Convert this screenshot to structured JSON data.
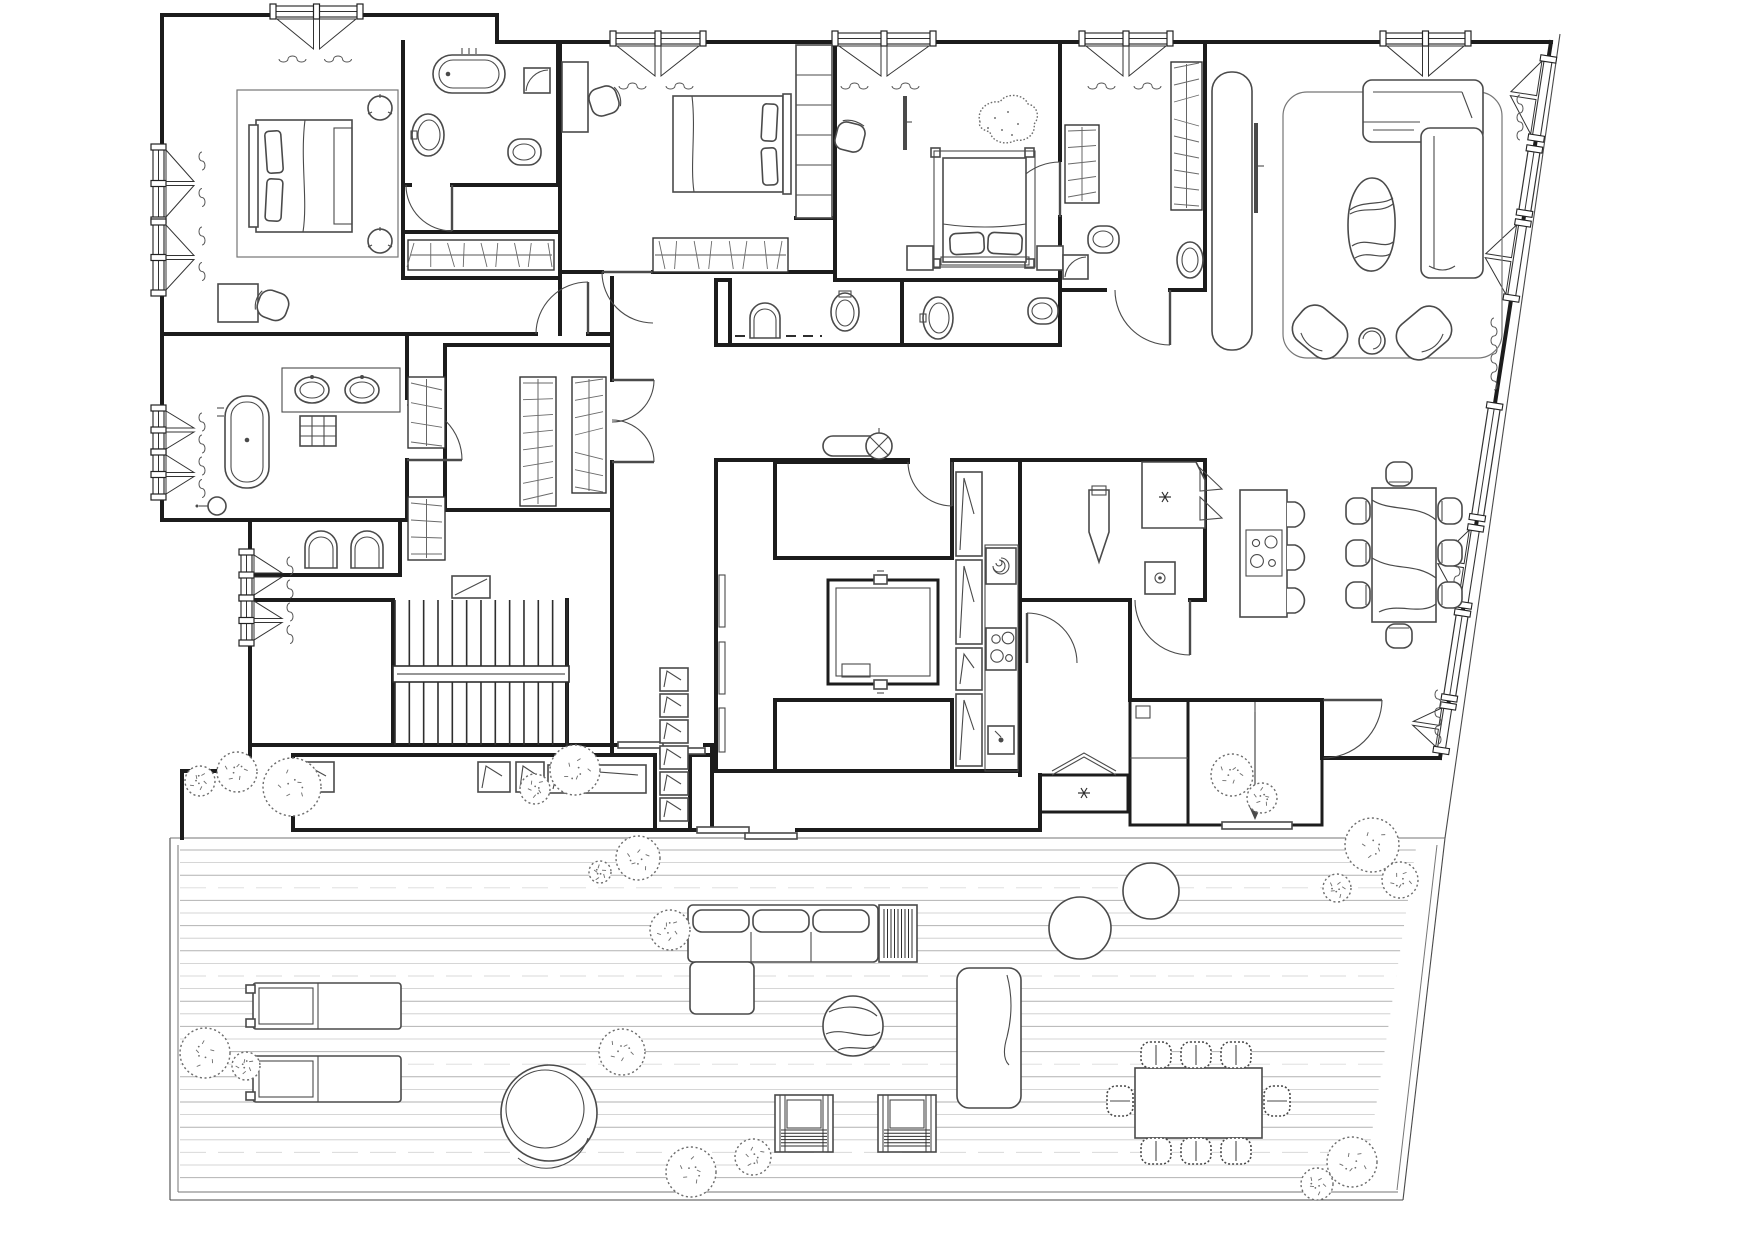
{
  "title": "Penthouse apartment floor plan with wrap-around deck terrace",
  "canvas": {
    "w": 1756,
    "h": 1242
  },
  "palette": {
    "paper": "#ffffff",
    "wall": "#1c1c1c",
    "ink": "#2e2e2e",
    "line": "#4a4a4a",
    "soft": "#767676",
    "deck": "#b2b2b2",
    "deck_alt": "#c9c9c9",
    "deck_faint": "#d9d9d9"
  },
  "deck": {
    "x1": 180,
    "y1": 850,
    "y2": 1188,
    "step": 12.6,
    "sx": 1557.5,
    "k": 0.155,
    "edge_left": [
      170,
      178
    ],
    "edge_bottom": [
      1192,
      1200
    ],
    "top": 838
  },
  "stairs": {
    "x1": 395,
    "x2": 567,
    "y_top1": 600,
    "y_top2": 666,
    "y_bot1": 682,
    "y_bot2": 745,
    "step": 14.33,
    "rail": [
      393,
      666,
      176,
      16
    ]
  },
  "bays_top": [
    {
      "x1": 273,
      "x2": 360,
      "y": 15
    },
    {
      "x1": 613,
      "x2": 703,
      "y": 42
    },
    {
      "x1": 835,
      "x2": 933,
      "y": 42
    },
    {
      "x1": 1082,
      "x2": 1170,
      "y": 42
    },
    {
      "x1": 1383,
      "x2": 1468,
      "y": 42
    }
  ],
  "bays_left": [
    {
      "x": 162,
      "y1": 147,
      "y2": 220
    },
    {
      "x": 162,
      "y1": 222,
      "y2": 293
    },
    {
      "x": 162,
      "y1": 408,
      "y2": 452
    },
    {
      "x": 162,
      "y1": 452,
      "y2": 497
    },
    {
      "x": 250,
      "y1": 552,
      "y2": 598
    },
    {
      "x": 250,
      "y1": 598,
      "y2": 643
    }
  ],
  "slant": {
    "x0": 1551,
    "y0": 42,
    "k": 0.155,
    "units": [
      {
        "y1": 58,
        "y2": 140,
        "t": "tri"
      },
      {
        "y1": 148,
        "y2": 215,
        "t": "rect"
      },
      {
        "y1": 222,
        "y2": 300,
        "t": "tri"
      },
      {
        "y1": 405,
        "y2": 520,
        "t": "rect"
      },
      {
        "y1": 527,
        "y2": 607,
        "t": "tri"
      },
      {
        "y1": 612,
        "y2": 700,
        "t": "rect"
      },
      {
        "y1": 705,
        "y2": 752,
        "t": "tri"
      }
    ],
    "waves": [
      {
        "x": 1520,
        "y": 95,
        "len": 45
      },
      {
        "x": 1494,
        "y": 318,
        "len": 80
      },
      {
        "x": 1457,
        "y": 540,
        "len": 58
      },
      {
        "x": 1438,
        "y": 690,
        "len": 56
      }
    ]
  },
  "closet_hatch": [
    {
      "x": 408,
      "y": 240,
      "w": 146,
      "h": 30,
      "o": "h"
    },
    {
      "x": 653,
      "y": 238,
      "w": 135,
      "h": 34,
      "o": "h"
    },
    {
      "x": 520,
      "y": 377,
      "w": 36,
      "h": 129,
      "o": "v"
    },
    {
      "x": 572,
      "y": 377,
      "w": 34,
      "h": 116,
      "o": "v"
    },
    {
      "x": 408,
      "y": 377,
      "w": 37,
      "h": 71,
      "o": "v"
    },
    {
      "x": 408,
      "y": 497,
      "w": 37,
      "h": 63,
      "o": "v"
    },
    {
      "x": 1065,
      "y": 125,
      "w": 34,
      "h": 78,
      "o": "v"
    },
    {
      "x": 1171,
      "y": 62,
      "w": 31,
      "h": 148,
      "o": "v"
    }
  ],
  "grills": [
    {
      "x": 884,
      "y": 909,
      "w": 28,
      "h": 49,
      "o": "v"
    },
    {
      "x": 781,
      "y": 1130,
      "w": 46,
      "h": 17,
      "o": "h"
    },
    {
      "x": 884,
      "y": 1130,
      "w": 46,
      "h": 17,
      "o": "h"
    }
  ],
  "bushes": [
    [
      200,
      781,
      15
    ],
    [
      237,
      772,
      20
    ],
    [
      292,
      787,
      29
    ],
    [
      535,
      789,
      15
    ],
    [
      575,
      770,
      25
    ],
    [
      638,
      858,
      22
    ],
    [
      600,
      872,
      11
    ],
    [
      670,
      930,
      20
    ],
    [
      1232,
      775,
      21
    ],
    [
      1262,
      798,
      15
    ],
    [
      1372,
      845,
      27
    ],
    [
      1400,
      880,
      18
    ],
    [
      1337,
      888,
      14
    ],
    [
      205,
      1053,
      25
    ],
    [
      246,
      1066,
      14
    ],
    [
      622,
      1052,
      23
    ],
    [
      691,
      1172,
      25
    ],
    [
      753,
      1157,
      18
    ],
    [
      1352,
      1162,
      25
    ],
    [
      1317,
      1184,
      16
    ]
  ],
  "dash_row": {
    "x1": 735,
    "x2": 822,
    "y": 336,
    "seg": 10,
    "gap": 7
  },
  "rooms": [
    "master-bedroom",
    "master-bathroom",
    "master-closet",
    "family-bathroom",
    "guest-wc",
    "walk-in-closet",
    "bedroom-2",
    "bedroom-3",
    "ensuite-bathroom-2",
    "ensuite-bathroom-3",
    "tv-pod-bathroom",
    "central-hallway",
    "staircase",
    "storage-rooms",
    "kitchen",
    "pantry-laundry",
    "utility-lobby",
    "cold-room",
    "elevator",
    "entrance-hall",
    "dining-area",
    "living-room",
    "terrace-deck"
  ],
  "furniture_inventory": [
    {
      "item": "double-bed",
      "qty": 3
    },
    {
      "item": "freestanding-bathtub",
      "qty": 2
    },
    {
      "item": "washbasin",
      "qty": 7
    },
    {
      "item": "toilet",
      "qty": 6
    },
    {
      "item": "shower",
      "qty": 3
    },
    {
      "item": "wardrobe-rail",
      "qty": 8
    },
    {
      "item": "l-shaped-sofa",
      "qty": 2
    },
    {
      "item": "coffee-table-organic",
      "qty": 1
    },
    {
      "item": "lounge-armchair",
      "qty": 2
    },
    {
      "item": "kitchen-island-with-hob",
      "qty": 1
    },
    {
      "item": "bar-stool",
      "qty": 3
    },
    {
      "item": "dining-table-marble",
      "qty": 1
    },
    {
      "item": "dining-chair",
      "qty": 8
    },
    {
      "item": "washing-machine",
      "qty": 1
    },
    {
      "item": "ironing-board",
      "qty": 1
    },
    {
      "item": "sun-lounger",
      "qty": 2
    },
    {
      "item": "papasan-chair",
      "qty": 1
    },
    {
      "item": "outdoor-modular-sofa",
      "qty": 1
    },
    {
      "item": "fire-table",
      "qty": 1
    },
    {
      "item": "marble-ball-table",
      "qty": 1
    },
    {
      "item": "daybed",
      "qty": 1
    },
    {
      "item": "wicker-armchair",
      "qty": 2
    },
    {
      "item": "outdoor-dining-table",
      "qty": 1
    },
    {
      "item": "outdoor-dining-chair",
      "qty": 8
    },
    {
      "item": "planter-pot",
      "qty": 2
    },
    {
      "item": "shrub",
      "qty": 20
    }
  ]
}
